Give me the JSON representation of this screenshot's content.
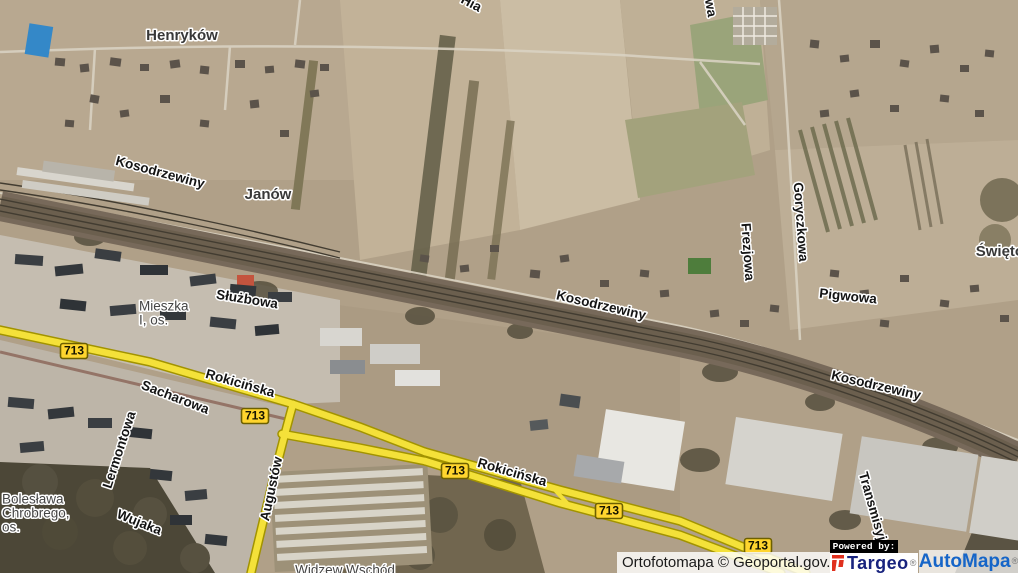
{
  "map": {
    "labels": [
      {
        "text": "Henryków",
        "x": 182,
        "y": 36,
        "rot": 0,
        "kind": "place"
      },
      {
        "text": "Kosodrzewiny",
        "x": 160,
        "y": 173,
        "rot": 15,
        "kind": "street"
      },
      {
        "text": "Janów",
        "x": 268,
        "y": 195,
        "rot": 0,
        "kind": "place"
      },
      {
        "text": "Hia",
        "x": 471,
        "y": 4,
        "rot": 28,
        "kind": "street"
      },
      {
        "text": "wa",
        "x": 710,
        "y": 8,
        "rot": 80,
        "kind": "street"
      },
      {
        "text": "Goryczkowa",
        "x": 800,
        "y": 222,
        "rot": 86,
        "kind": "street"
      },
      {
        "text": "Frezjowa",
        "x": 747,
        "y": 252,
        "rot": 86,
        "kind": "street"
      },
      {
        "text": "Pigwowa",
        "x": 848,
        "y": 297,
        "rot": 6,
        "kind": "street"
      },
      {
        "text": "Świętoł",
        "x": 1002,
        "y": 252,
        "rot": 0,
        "kind": "place"
      },
      {
        "text": "Kosodrzewiny",
        "x": 601,
        "y": 306,
        "rot": 13,
        "kind": "street"
      },
      {
        "text": "Służbowa",
        "x": 247,
        "y": 300,
        "rot": 9,
        "kind": "street"
      },
      {
        "text": "Mieszka",
        "x": 139,
        "y": 307,
        "rot": 0,
        "kind": "district",
        "anchor": "start"
      },
      {
        "text": "I, os.",
        "x": 139,
        "y": 321,
        "rot": 0,
        "kind": "district",
        "anchor": "start"
      },
      {
        "text": "Rokicińska",
        "x": 240,
        "y": 384,
        "rot": 16,
        "kind": "street"
      },
      {
        "text": "Sacharowa",
        "x": 175,
        "y": 398,
        "rot": 21,
        "kind": "street"
      },
      {
        "text": "Kosodrzewiny",
        "x": 876,
        "y": 386,
        "rot": 13,
        "kind": "street"
      },
      {
        "text": "Lermontowa",
        "x": 120,
        "y": 450,
        "rot": -72,
        "kind": "street"
      },
      {
        "text": "Bolesława",
        "x": 2,
        "y": 500,
        "rot": 0,
        "kind": "district",
        "anchor": "start"
      },
      {
        "text": "Chrobrego,",
        "x": 2,
        "y": 514,
        "rot": 0,
        "kind": "district",
        "anchor": "start"
      },
      {
        "text": "os.",
        "x": 2,
        "y": 528,
        "rot": 0,
        "kind": "district",
        "anchor": "start"
      },
      {
        "text": "Wujaka",
        "x": 139,
        "y": 523,
        "rot": 22,
        "kind": "street"
      },
      {
        "text": "Augustów",
        "x": 272,
        "y": 489,
        "rot": -78,
        "kind": "street"
      },
      {
        "text": "Rokicińska",
        "x": 512,
        "y": 473,
        "rot": 16,
        "kind": "street"
      },
      {
        "text": "Transmisyjna",
        "x": 874,
        "y": 514,
        "rot": 74,
        "kind": "street"
      },
      {
        "text": "Widzew Wschód",
        "x": 345,
        "y": 571,
        "rot": 0,
        "kind": "district"
      }
    ],
    "route_badges": {
      "text": "713",
      "positions": [
        {
          "x": 74,
          "y": 351
        },
        {
          "x": 255,
          "y": 416
        },
        {
          "x": 455,
          "y": 471
        },
        {
          "x": 609,
          "y": 511
        },
        {
          "x": 758,
          "y": 546
        }
      ]
    },
    "attribution": {
      "source": "Ortofotomapa © Geoportal.gov.pl",
      "powered_by": "Powered by:",
      "targeo": "Targeo",
      "targeo_reg": "®",
      "automapa": "AutoMapa",
      "automapa_reg": "®"
    },
    "colors": {
      "road_yellow": "#f4e139",
      "road_casing": "#a29300",
      "badge_yellow": "#ffd52e",
      "targeo_blue": "#18237e",
      "targeo_red": "#e0301e",
      "automapa_blue": "#1565c8"
    }
  }
}
